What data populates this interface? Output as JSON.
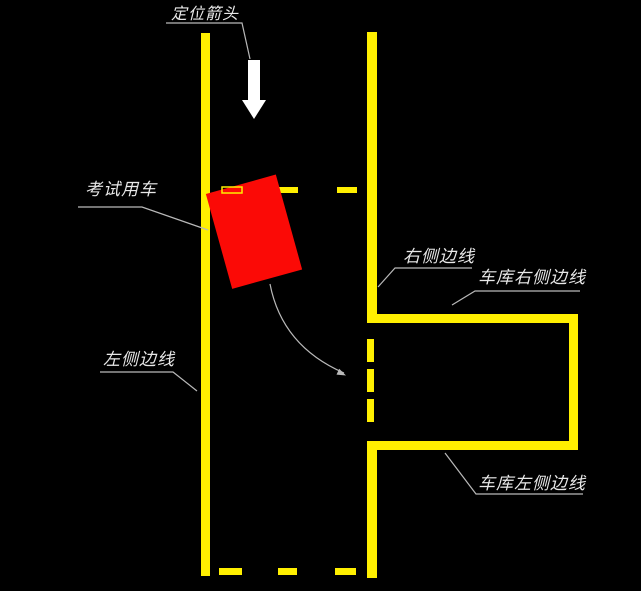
{
  "diagram": {
    "colors": {
      "background": "#000000",
      "boundary_yellow": "#ffef00",
      "car_red": "#fb0a06",
      "arrow_white": "#ffffff",
      "leader_gray": "#b9b9b9",
      "text_light": "#e8e8e8"
    },
    "labels": {
      "positioning_arrow": "定位箭头",
      "exam_vehicle": "考试用车",
      "left_side_line": "左侧边线",
      "right_side_line": "右侧边线",
      "garage_right_side_line": "车库右侧边线",
      "garage_left_side_line": "车库左侧边线"
    }
  }
}
